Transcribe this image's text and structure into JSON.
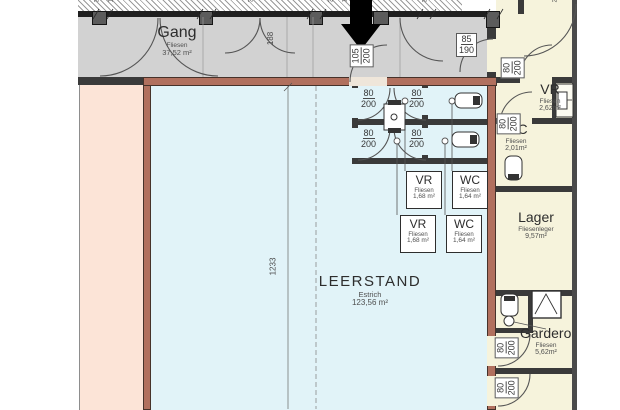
{
  "plan": {
    "rooms": {
      "gang": {
        "name": "Gang",
        "floor": "Fliesen",
        "area": "37,52 m²"
      },
      "leerstand": {
        "name": "LEERSTAND",
        "floor": "Estrich",
        "area": "123,56 m²"
      },
      "vr_top": {
        "name": "VR",
        "floor": "Fliesen",
        "area": "1,68 m²"
      },
      "wc_top": {
        "name": "WC",
        "floor": "Fliesen",
        "area": "1,64 m²"
      },
      "vr_bottom": {
        "name": "VR",
        "floor": "Fliesen",
        "area": "1,68 m²"
      },
      "wc_bottom": {
        "name": "WC",
        "floor": "Fliesen",
        "area": "1,64 m²"
      },
      "vr_right": {
        "name": "VR",
        "floor": "Fliesen",
        "area": "2,62m²"
      },
      "wc_right": {
        "name": "WC",
        "floor": "Fliesen",
        "area": "2,01m²"
      },
      "lager": {
        "name": "Lager",
        "floor": "Fliesenleger",
        "area": "9,57m²"
      },
      "garderobe": {
        "name": "Garderobe",
        "floor": "Fliesen",
        "area": "5,62m²"
      }
    },
    "dimensions": {
      "door_80": "80",
      "door_200": "200",
      "door_105": "105",
      "door_85": "85",
      "door_190": "190",
      "double_door": "188",
      "wall_length": "1233"
    },
    "edge_fragments": [
      {
        "t": "35"
      },
      {
        "t": "14"
      },
      {
        "t": "34"
      },
      {
        "t": "30"
      },
      {
        "t": "14"
      },
      {
        "t": "35"
      },
      {
        "t": "25"
      }
    ],
    "colors": {
      "corridor_gray": "#d2d2d2",
      "vacancy_blue": "#e1f3f8",
      "neighbor_pink": "#fce4d7",
      "neighbor_cream": "#f6f3dc",
      "highlight_wall": "#b1705e",
      "wall_dark": "#3a3a3a",
      "arrow_black": "#000000"
    }
  }
}
